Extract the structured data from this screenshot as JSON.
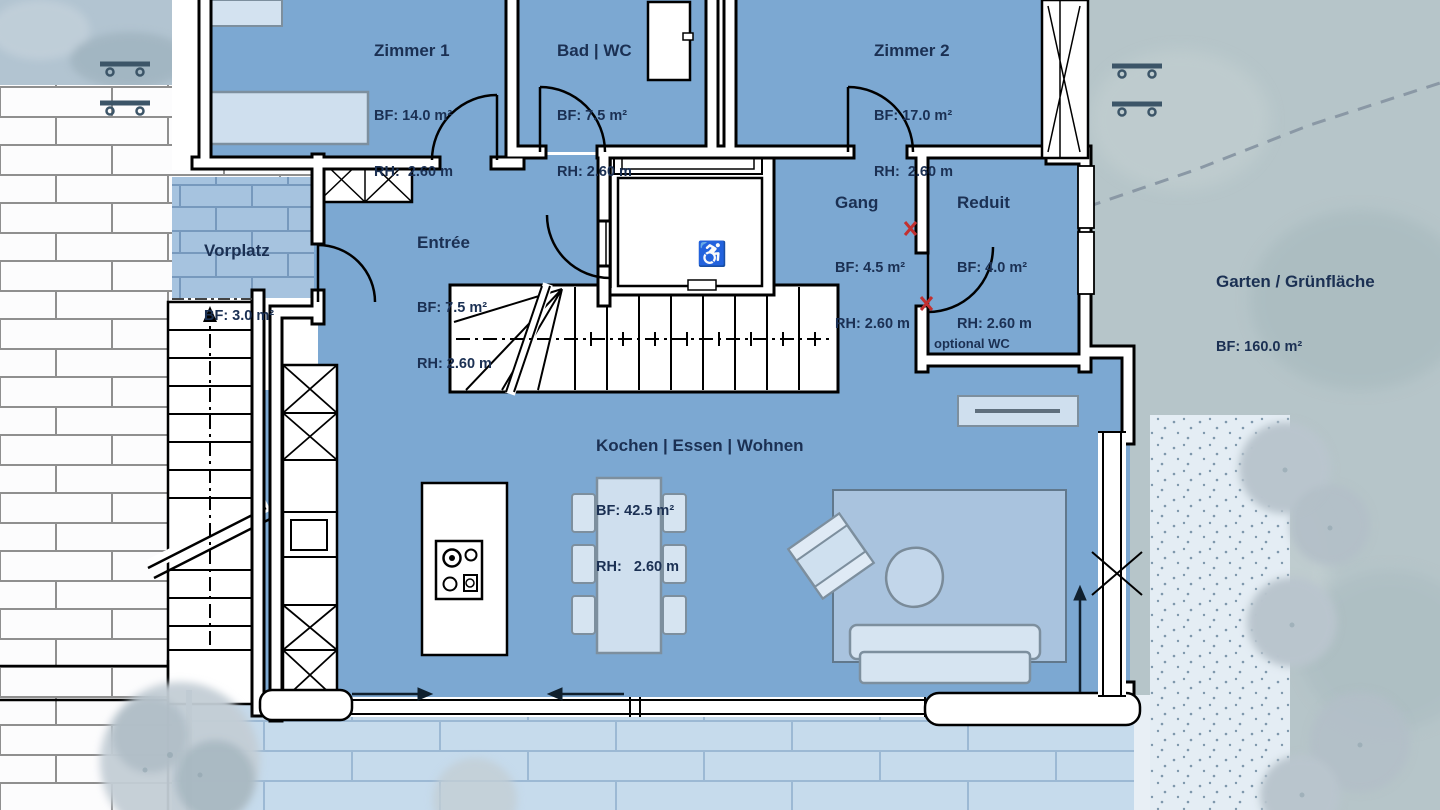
{
  "rooms": [
    {
      "name": "Zimmer 1",
      "bf": "BF: 14.0 m²",
      "rh": "RH:  2.60 m"
    },
    {
      "name": "Bad | WC",
      "bf": "BF: 7.5 m²",
      "rh": "RH: 2.60 m"
    },
    {
      "name": "Zimmer 2",
      "bf": "BF: 17.0 m²",
      "rh": "RH:  2.60 m"
    },
    {
      "name": "Vorplatz",
      "bf": "BF: 3.0 m²",
      "rh": ""
    },
    {
      "name": "Entrée",
      "bf": "BF: 7.5 m²",
      "rh": "RH: 2.60 m"
    },
    {
      "name": "Gang",
      "bf": "BF: 4.5 m²",
      "rh": "RH: 2.60 m"
    },
    {
      "name": "Reduit",
      "bf": "BF: 4.0 m²",
      "rh": "RH: 2.60 m"
    },
    {
      "name": "Kochen | Essen | Wohnen",
      "bf": "BF: 42.5 m²",
      "rh": "RH:   2.60 m"
    },
    {
      "name": "Garten / Grünfläche",
      "bf": "BF: 160.0 m²",
      "rh": ""
    }
  ],
  "annotations": {
    "optional_wc": "optional WC"
  },
  "elevator": {
    "accessible_icon": "♿"
  },
  "palette": {
    "room_fill": "#7ca8d2",
    "label_text": "#1b3053",
    "wall_line": "#000000",
    "marker_red": "#c23030",
    "terrace_brick": "#c6dbec",
    "vorplatz_brick": "#a6c3df",
    "garden": "#b6c5c9",
    "gravel": "#e4edf4",
    "furniture_light": "#cfe0ef"
  }
}
